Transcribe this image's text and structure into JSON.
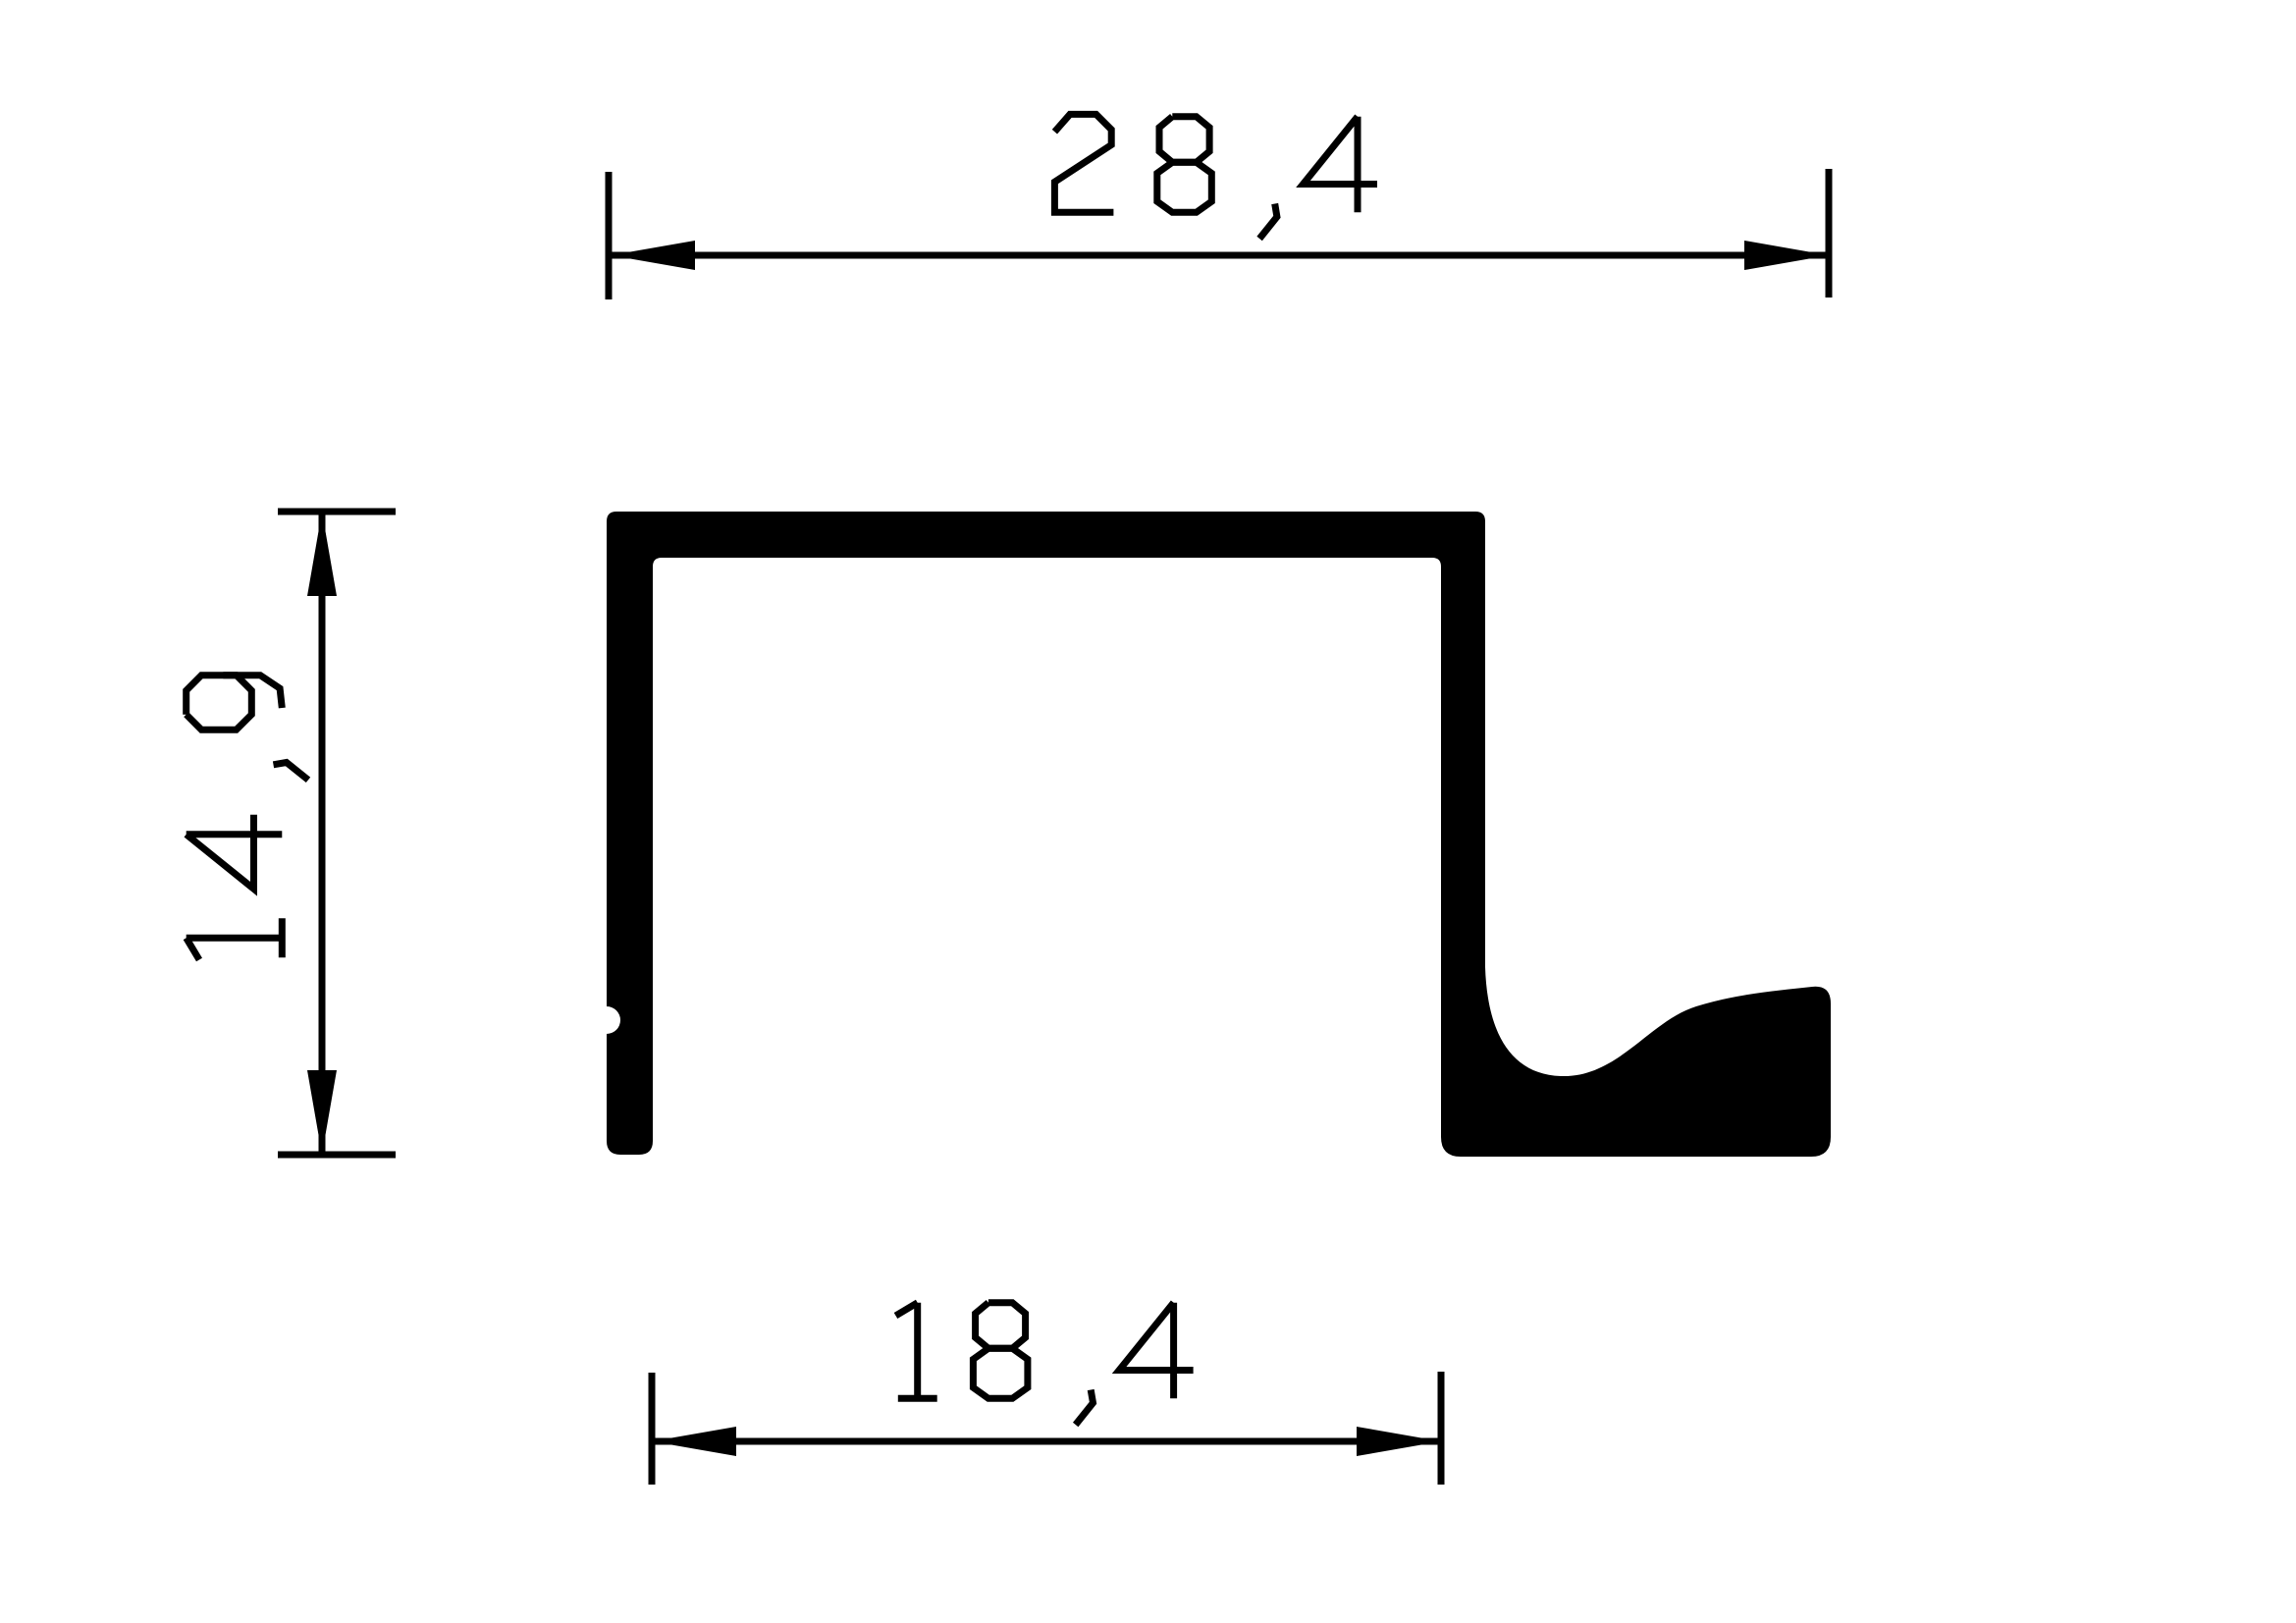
{
  "drawing": {
    "type": "technical-profile-cross-section",
    "colors": {
      "ink": "#000000",
      "background": "#ffffff"
    },
    "dimensions": {
      "top": {
        "value": "28,4",
        "orientation": "horizontal"
      },
      "left": {
        "value": "14,9",
        "orientation": "vertical"
      },
      "bottom": {
        "value": "18,4",
        "orientation": "horizontal"
      }
    }
  }
}
